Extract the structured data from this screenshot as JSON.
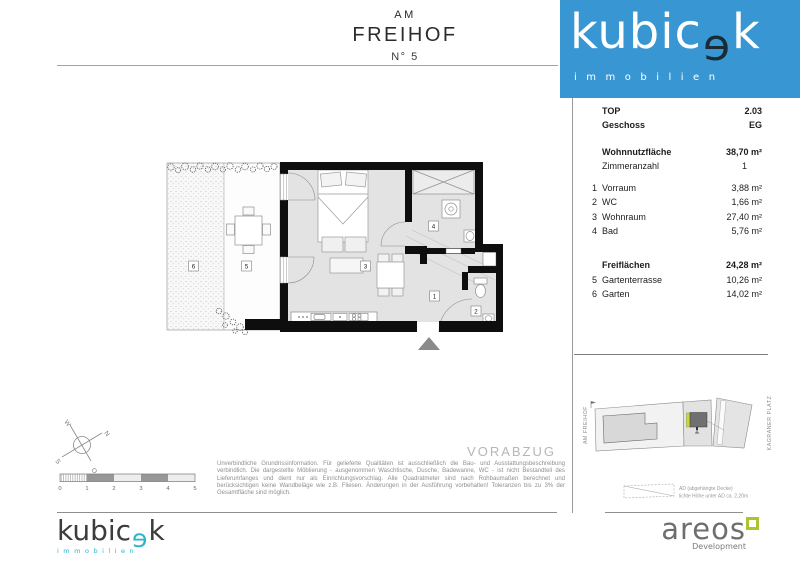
{
  "title": {
    "line1": "AM",
    "line2": "FREIHOF",
    "line3": "N° 5"
  },
  "brand": {
    "pre": "kubic",
    "e": "ɘ",
    "post": "k",
    "sub": "immobilien"
  },
  "colors": {
    "brand_blue": "#3897d3",
    "brand_dark": "#1b2a33",
    "brand_cyan": "#2fb3c6",
    "areos_green": "#aec32d",
    "wall_black": "#0e0e0e",
    "floor_gray": "#e3e3e3"
  },
  "panel": {
    "top": {
      "label": "TOP",
      "value": "2.03"
    },
    "geschoss": {
      "label": "Geschoss",
      "value": "EG"
    },
    "wohnnutzflaeche": {
      "label": "Wohnnutzfläche",
      "value": "38,70 m²"
    },
    "zimmeranzahl": {
      "label": "Zimmeranzahl",
      "value": "1"
    },
    "rooms": [
      {
        "num": "1",
        "label": "Vorraum",
        "value": "3,88 m²"
      },
      {
        "num": "2",
        "label": "WC",
        "value": "1,66 m²"
      },
      {
        "num": "3",
        "label": "Wohnraum",
        "value": "27,40 m²"
      },
      {
        "num": "4",
        "label": "Bad",
        "value": "5,76 m²"
      }
    ],
    "freiflaechen": {
      "label": "Freiflächen",
      "value": "24,28 m²"
    },
    "freirooms": [
      {
        "num": "5",
        "label": "Gartenterrasse",
        "value": "10,26 m²"
      },
      {
        "num": "6",
        "label": "Garten",
        "value": "14,02 m²"
      }
    ]
  },
  "plan": {
    "labels": {
      "r1": "1",
      "r2": "2",
      "r3": "3",
      "r4": "4",
      "r5": "5",
      "r6": "6"
    }
  },
  "siteplan": {
    "left_label": "AM FREIHOF",
    "right_label": "KAGRANER PLATZ"
  },
  "legend": {
    "line1": "AD (abgehängte Decke)",
    "line2": "lichte Höhe unter AD ca. 2,20m"
  },
  "compass": {
    "n": "N",
    "o": "O",
    "s": "S",
    "w": "W"
  },
  "scalebar": {
    "ticks": [
      "0",
      "1",
      "2",
      "3",
      "4",
      "5"
    ]
  },
  "watermark": "VORABZUG",
  "disclaimer": "Unverbindliche Grundrissinformation. Für gelieferte Qualitäten ist ausschließlich die Bau- und Ausstattungsbeschreibung verbindlich. Die dargestellte Möblierung - ausgenommen Waschtische, Dusche, Badewanne, WC - ist nicht Bestandteil des Lieferumfanges und dient nur als Einrichtungsvorschlag. Alle Quadratmeter sind nach Rohbaumaßen berechnet und berücksichtigen keine Wandbeläge wie z.B. Fliesen. Änderungen in der Ausführung vorbehalten! Toleranzen bis zu 3% der Gesamtfläche sind möglich.",
  "footer": {
    "areos": {
      "name": "areos",
      "sub": "Development"
    }
  }
}
